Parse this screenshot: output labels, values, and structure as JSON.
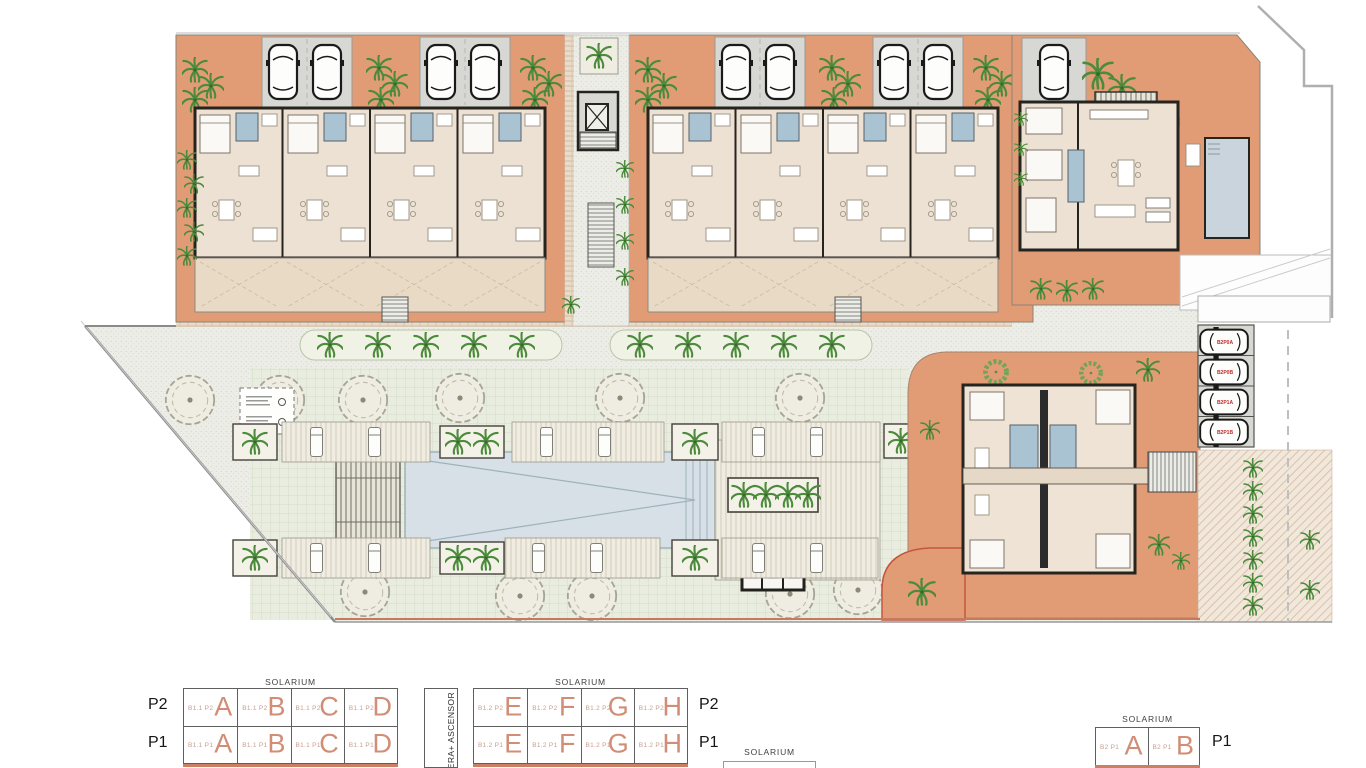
{
  "plan": {
    "parking_labels": [
      "B2P0A",
      "B2P0B",
      "B2P1A",
      "B2P1B"
    ],
    "colors": {
      "terrace_orange": "#E29C75",
      "interior_beige": "#EDE1D3",
      "terrace_light": "#E9DAC5",
      "parking_gray": "#D7D7D3",
      "pool_blue": "#D6E0E6",
      "plant_green": "#4C8A3C",
      "wall_dark": "#26241F",
      "parking_label_red": "#C02A2A",
      "legend_accent": "#D18D75"
    }
  },
  "legend": {
    "solarium_title": "SOLARIUM",
    "elevator_label": "ESCALERA+ ASCENSOR",
    "blocks": {
      "b11": {
        "rows": [
          {
            "level": "P2",
            "code": "B1.1 P2",
            "letters": [
              "A",
              "B",
              "C",
              "D"
            ]
          },
          {
            "level": "P1",
            "code": "B1.1 P1",
            "letters": [
              "A",
              "B",
              "C",
              "D"
            ]
          }
        ]
      },
      "b12": {
        "rows": [
          {
            "level": "P2",
            "code": "B1.2 P2",
            "letters": [
              "E",
              "F",
              "G",
              "H"
            ]
          },
          {
            "level": "P1",
            "code": "B1.2 P1",
            "letters": [
              "E",
              "F",
              "G",
              "H"
            ]
          }
        ]
      },
      "b2": {
        "rows": [
          {
            "level": "P1",
            "code": "B2 P1",
            "letters": [
              "A",
              "B"
            ]
          }
        ]
      }
    }
  }
}
